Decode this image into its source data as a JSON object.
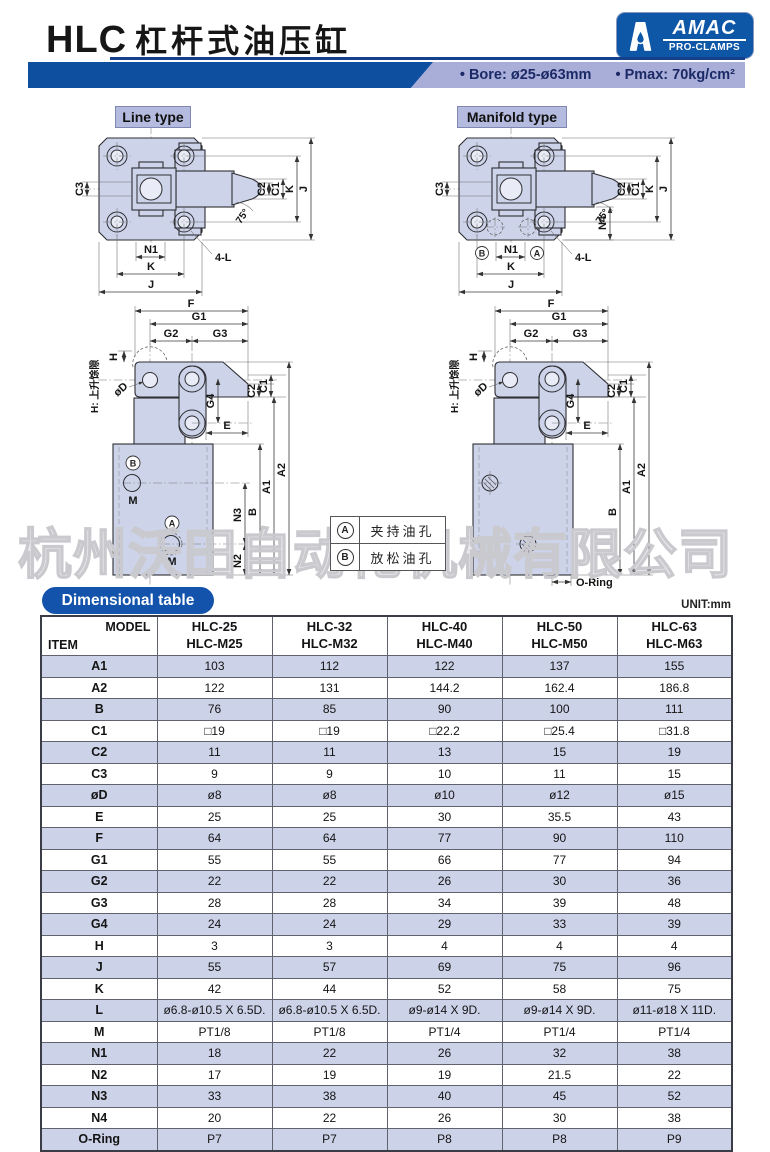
{
  "header": {
    "title_en": "HLC",
    "title_cn": "杠杆式油压缸",
    "logo_brand": "AMAC",
    "logo_sub": "PRO-CLAMPS",
    "spec_bore": "• Bore: ø25-ø63mm",
    "spec_pmax": "• Pmax: 70kg/cm²"
  },
  "diagram": {
    "line_type_label": "Line type",
    "manifold_type_label": "Manifold type",
    "dims": {
      "a1": "A1",
      "a2": "A2",
      "b": "B",
      "c1": "C1",
      "c2": "C2",
      "c3": "C3",
      "d": "øD",
      "e": "E",
      "f": "F",
      "g1": "G1",
      "g2": "G2",
      "g3": "G3",
      "g4": "G4",
      "h": "H",
      "j": "J",
      "k": "K",
      "l": "4-L",
      "m": "M",
      "n1": "N1",
      "n2": "N2",
      "n3": "N3",
      "n4": "N4",
      "angle": "75°",
      "oring": "O-Ring",
      "h_note": "H: 上升馀隙",
      "port_a": "A",
      "port_b": "B"
    }
  },
  "legend": {
    "rows": [
      {
        "key": "A",
        "label": "夹持油孔"
      },
      {
        "key": "B",
        "label": "放松油孔"
      }
    ]
  },
  "watermark": "杭州沃田自动化机械有限公司",
  "table": {
    "heading": "Dimensional table",
    "unit": "UNIT:mm",
    "corner_top": "MODEL",
    "corner_bottom": "ITEM",
    "columns": [
      {
        "line1": "HLC-25",
        "line2": "HLC-M25"
      },
      {
        "line1": "HLC-32",
        "line2": "HLC-M32"
      },
      {
        "line1": "HLC-40",
        "line2": "HLC-M40"
      },
      {
        "line1": "HLC-50",
        "line2": "HLC-M50"
      },
      {
        "line1": "HLC-63",
        "line2": "HLC-M63"
      }
    ],
    "rows": [
      {
        "item": "A1",
        "values": [
          "103",
          "112",
          "122",
          "137",
          "155"
        ]
      },
      {
        "item": "A2",
        "values": [
          "122",
          "131",
          "144.2",
          "162.4",
          "186.8"
        ]
      },
      {
        "item": "B",
        "values": [
          "76",
          "85",
          "90",
          "100",
          "111"
        ]
      },
      {
        "item": "C1",
        "values": [
          "□19",
          "□19",
          "□22.2",
          "□25.4",
          "□31.8"
        ]
      },
      {
        "item": "C2",
        "values": [
          "11",
          "11",
          "13",
          "15",
          "19"
        ]
      },
      {
        "item": "C3",
        "values": [
          "9",
          "9",
          "10",
          "11",
          "15"
        ]
      },
      {
        "item": "øD",
        "values": [
          "ø8",
          "ø8",
          "ø10",
          "ø12",
          "ø15"
        ]
      },
      {
        "item": "E",
        "values": [
          "25",
          "25",
          "30",
          "35.5",
          "43"
        ]
      },
      {
        "item": "F",
        "values": [
          "64",
          "64",
          "77",
          "90",
          "110"
        ]
      },
      {
        "item": "G1",
        "values": [
          "55",
          "55",
          "66",
          "77",
          "94"
        ]
      },
      {
        "item": "G2",
        "values": [
          "22",
          "22",
          "26",
          "30",
          "36"
        ]
      },
      {
        "item": "G3",
        "values": [
          "28",
          "28",
          "34",
          "39",
          "48"
        ]
      },
      {
        "item": "G4",
        "values": [
          "24",
          "24",
          "29",
          "33",
          "39"
        ]
      },
      {
        "item": "H",
        "values": [
          "3",
          "3",
          "4",
          "4",
          "4"
        ]
      },
      {
        "item": "J",
        "values": [
          "55",
          "57",
          "69",
          "75",
          "96"
        ]
      },
      {
        "item": "K",
        "values": [
          "42",
          "44",
          "52",
          "58",
          "75"
        ]
      },
      {
        "item": "L",
        "values": [
          "ø6.8-ø10.5 X 6.5D.",
          "ø6.8-ø10.5 X 6.5D.",
          "ø9-ø14 X 9D.",
          "ø9-ø14 X 9D.",
          "ø11-ø18 X 11D."
        ]
      },
      {
        "item": "M",
        "values": [
          "PT1/8",
          "PT1/8",
          "PT1/4",
          "PT1/4",
          "PT1/4"
        ]
      },
      {
        "item": "N1",
        "values": [
          "18",
          "22",
          "26",
          "32",
          "38"
        ]
      },
      {
        "item": "N2",
        "values": [
          "17",
          "19",
          "19",
          "21.5",
          "22"
        ]
      },
      {
        "item": "N3",
        "values": [
          "33",
          "38",
          "40",
          "45",
          "52"
        ]
      },
      {
        "item": "N4",
        "values": [
          "20",
          "22",
          "26",
          "30",
          "38"
        ]
      },
      {
        "item": "O-Ring",
        "values": [
          "P7",
          "P7",
          "P8",
          "P8",
          "P9"
        ]
      }
    ]
  }
}
